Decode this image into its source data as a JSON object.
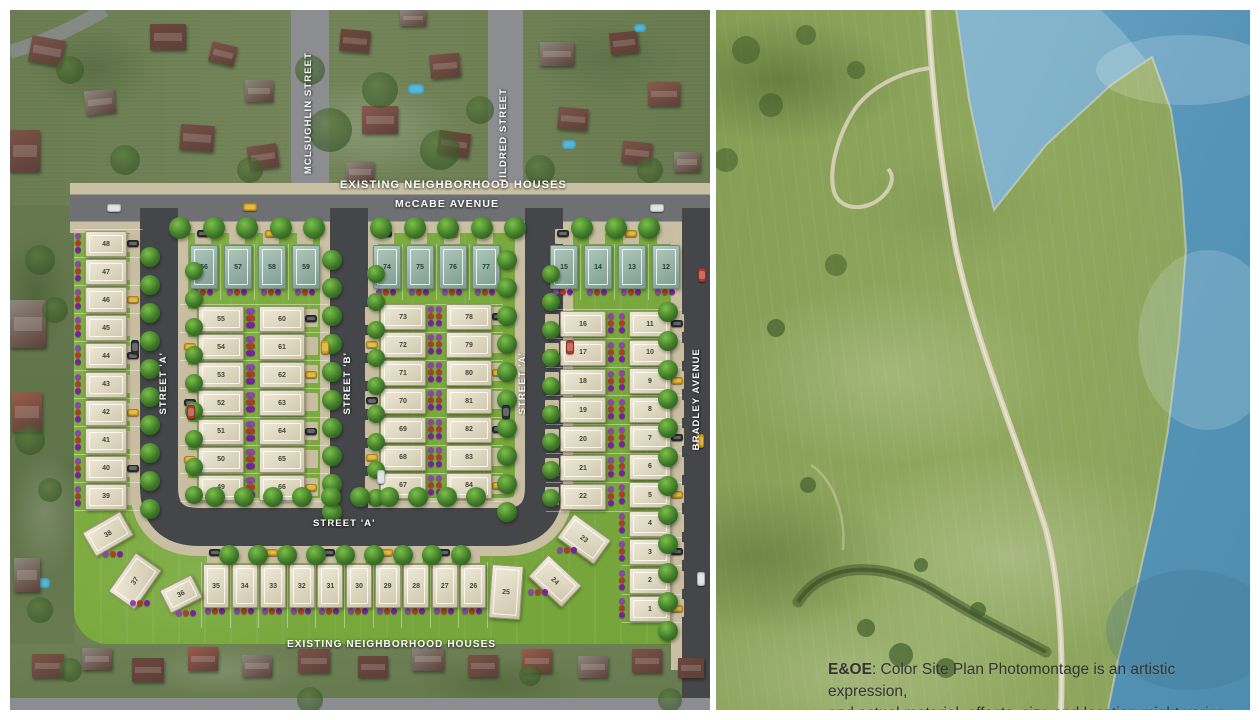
{
  "site_plan": {
    "labels": {
      "mclsughlin_street": "MCLSUGHLIN STREET",
      "hildred_street": "HILDRED STREET",
      "mccabe_avenue": "McCABE AVENUE",
      "existing_houses_top": "EXISTING NEIGHBORHOOD HOUSES",
      "existing_houses_bottom": "EXISTING NEIGHBORHOOD HOUSES",
      "street_a_west": "STREET 'A'",
      "street_b": "STREET 'B'",
      "street_a_east": "STREET 'A'",
      "street_a_south": "STREET 'A'",
      "bradley_avenue": "BRADLEY AVENUE"
    },
    "lots": {
      "west_column": [
        48,
        47,
        46,
        45,
        44,
        43,
        42,
        41,
        40,
        39
      ],
      "block_a": {
        "top_row": [
          56,
          57,
          58,
          59
        ],
        "left_column": [
          55,
          54,
          53,
          52,
          51,
          50,
          49
        ],
        "right_column": [
          60,
          61,
          62,
          63,
          64,
          65,
          66
        ]
      },
      "block_b": {
        "top_row": [
          74,
          75,
          76,
          77
        ],
        "left_column": [
          73,
          72,
          71,
          70,
          69,
          68,
          67
        ],
        "right_column": [
          78,
          79,
          80,
          81,
          82,
          83,
          84
        ]
      },
      "block_c": {
        "top_row": [
          15,
          14,
          13,
          12
        ],
        "left_column": [
          16,
          17,
          18,
          19,
          20,
          21,
          22
        ],
        "right_column": [
          11,
          10,
          9,
          8,
          7,
          6,
          5,
          4,
          3,
          2,
          1
        ]
      },
      "south_row": [
        35,
        34,
        33,
        32,
        31,
        30,
        29,
        28,
        27,
        26,
        25
      ],
      "angled_west": [
        38,
        37,
        36
      ],
      "angled_east": [
        23,
        24
      ]
    },
    "colors": {
      "site_grass": "#7aa93e",
      "road_dark": "#454649",
      "road_light": "#8b8d90",
      "lot_fill": "#ddd6c0",
      "lot_teal": "#99b5a9",
      "driveway_tan": "#c8bda0",
      "tree_green": "#3f7a28",
      "label_white": "#ffffff"
    }
  },
  "photo_panel": {
    "colors": {
      "water_blue": "#5795b8",
      "field_green": "#8aa25a"
    },
    "disclaimer": {
      "prefix": "E&OE",
      "line1": ": Color Site Plan Photomontage is an artistic expression,",
      "line2": "and actual material, effects, size and location might varies."
    }
  }
}
